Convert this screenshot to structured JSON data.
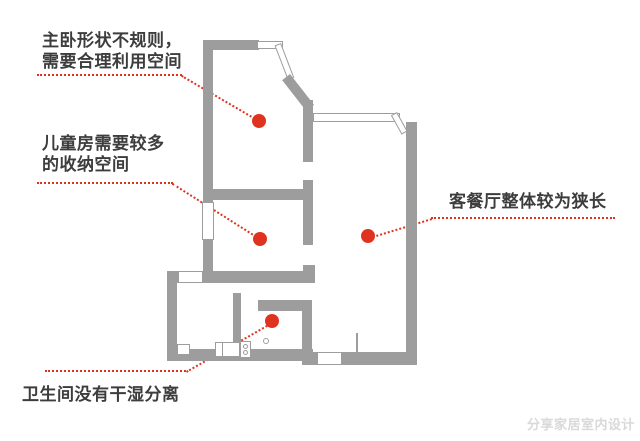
{
  "colors": {
    "wall": "#9d9d9d",
    "accent": "#e0331f",
    "text": "#3d3d3d",
    "watermark": "#d9d9d9"
  },
  "annotations": {
    "master_bedroom": {
      "line1": "主卧形状不规则，",
      "line2": "需要合理利用空间"
    },
    "kids_room": {
      "line1": "儿童房需要较多",
      "line2": "的收纳空间"
    },
    "living_dining": {
      "line1": "客餐厅整体较为狭长"
    },
    "bathroom": {
      "line1": "卫生间没有干湿分离"
    }
  },
  "watermark": {
    "text": "分享家居室内设计"
  }
}
